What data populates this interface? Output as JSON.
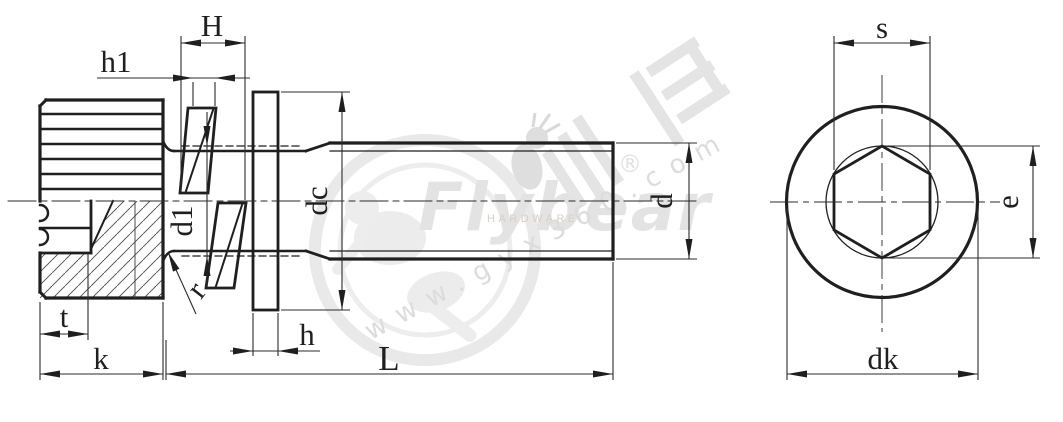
{
  "drawing": {
    "left_view": {
      "labels": {
        "H": "H",
        "h1": "h1",
        "dc": "dc",
        "d": "d",
        "d1": "d1",
        "r": "r",
        "t": "t",
        "k": "k",
        "h": "h",
        "L": "L"
      }
    },
    "right_view": {
      "labels": {
        "s": "s",
        "e": "e",
        "dk": "dk"
      }
    },
    "watermark": {
      "brand": "Flybear",
      "brand_sub": "HARDWARE",
      "registered": "®",
      "url": "www.gyx360.com"
    },
    "colors": {
      "line": "#1f1f1f",
      "dimension": "#2b2b2b",
      "watermark_light": "#e4e4e4",
      "background": "#ffffff"
    }
  }
}
